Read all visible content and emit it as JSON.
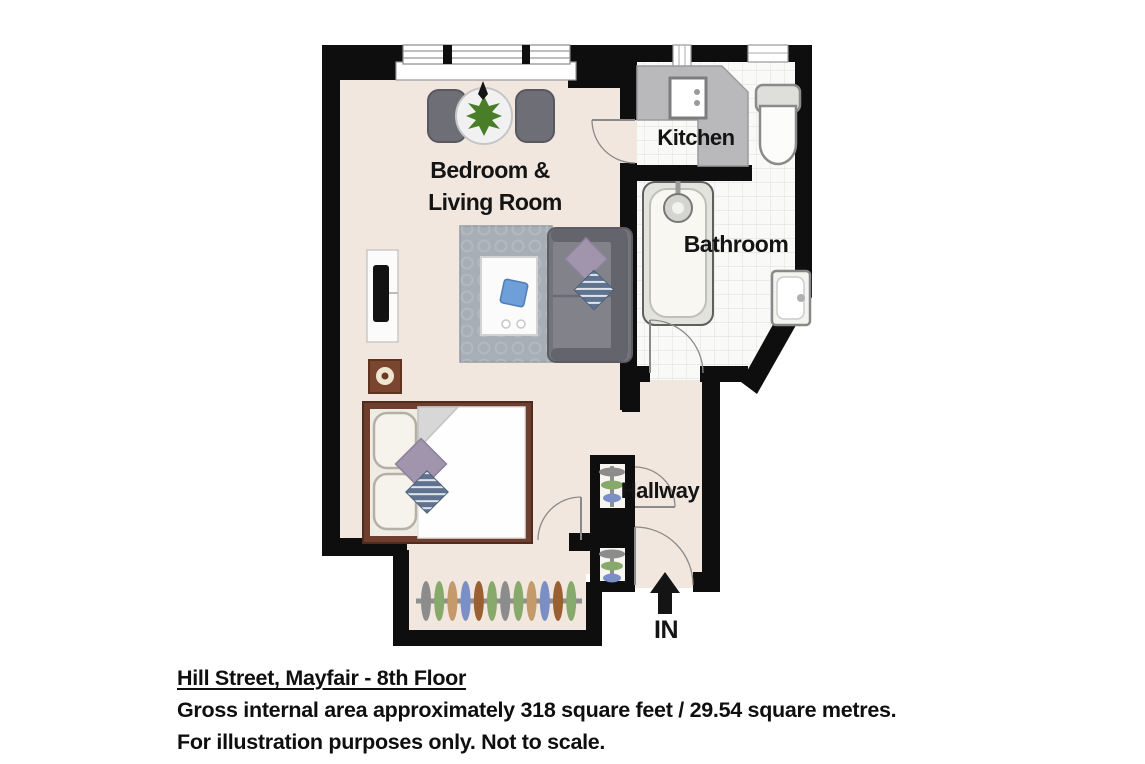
{
  "floorplan": {
    "labels": {
      "bedroom_living_1": "Bedroom &",
      "bedroom_living_2": "Living Room",
      "kitchen": "Kitchen",
      "bathroom": "Bathroom",
      "hallway": "Hallway",
      "entrance": "IN"
    },
    "colors": {
      "wall": "#0e0e0e",
      "floor": "#f2e7de",
      "tile": "#f9f9f8",
      "counter": "#b9b9bb",
      "rug": "#a8aeb6",
      "sofa": "#73737c",
      "sofa_trim": "#64646d",
      "bed_frame": "#6e3f2e",
      "pillow_purple": "#a195ae",
      "blanket_blue": "#5f7390",
      "plant": "#4a7d28",
      "speaker": "#7a4630",
      "book_blue": "#6f9fd8",
      "door_arc": "#8a8a8a"
    },
    "wardrobe_hangers": [
      "#8c8c8c",
      "#87a96b",
      "#c49a6c",
      "#7b8fc7",
      "#9a5f32",
      "#87a96b",
      "#8c8c8c",
      "#87a96b",
      "#c49a6c",
      "#7b8fc7",
      "#9a5f32",
      "#87a96b"
    ],
    "closet_hangers_upper": [
      "#8c8c8c",
      "#87a96b",
      "#7b8fc7"
    ],
    "closet_hangers_lower": [
      "#8c8c8c",
      "#87a96b",
      "#7b8fc7"
    ]
  },
  "caption": {
    "title": "Hill Street, Mayfair - 8th Floor",
    "area_line": "Gross internal area approximately 318 square feet / 29.54 square metres.",
    "disclaimer": "For illustration purposes only. Not to scale."
  }
}
